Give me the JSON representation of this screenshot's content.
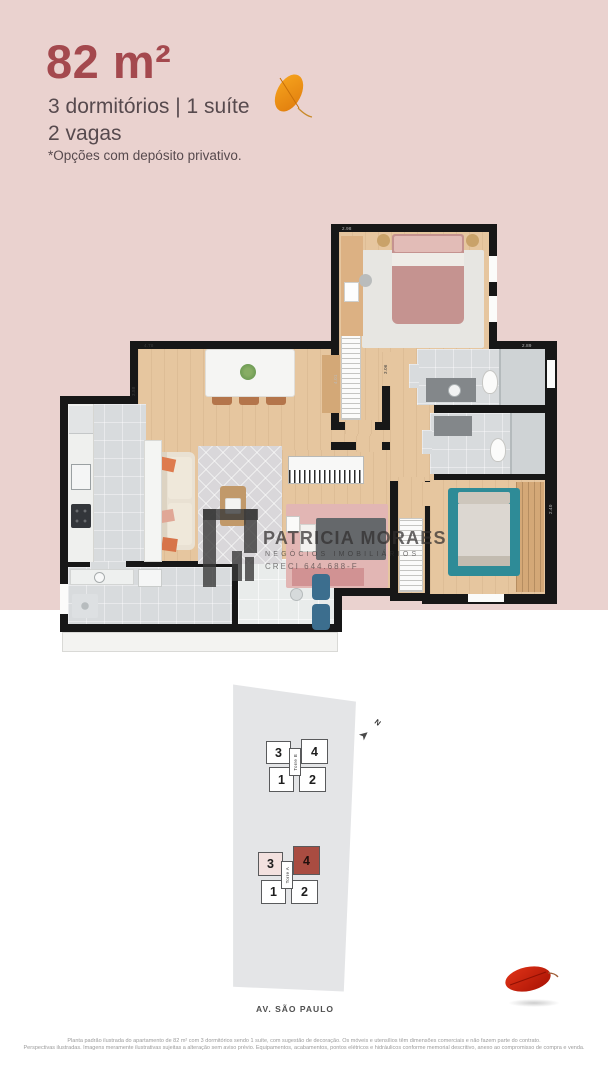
{
  "header": {
    "area": "82 m²",
    "features_line1": "3 dormitórios | 1 suíte",
    "features_line2": "2 vagas",
    "note": "*Opções com depósito privativo.",
    "accent_color": "#a4494e",
    "background_color": "#ead2cf"
  },
  "watermark": {
    "name": "PATRICIA MORAES",
    "subtitle": "NEGÓCIOS IMOBILIÁRIOS",
    "creci": "CRECI 644.688-F"
  },
  "floor_plan": {
    "dims": [
      "4.78",
      "3.58",
      "2.98",
      "2.89",
      "3.06",
      "2.40",
      "4.01"
    ]
  },
  "site_plan": {
    "north_label": "N",
    "towers": [
      {
        "name": "Torre B",
        "units": [
          "3",
          "4",
          "1",
          "2"
        ],
        "highlighted_unit": ""
      },
      {
        "name": "Torre A",
        "units": [
          "3",
          "4",
          "1",
          "2"
        ],
        "highlighted_unit": "4"
      }
    ],
    "street": "AV. SÃO PAULO",
    "highlight_color": "#a94c41"
  },
  "disclaimer": {
    "line1": "Planta padrão ilustrada do apartamento de 82 m² com 3 dormitórios sendo 1 suíte, com sugestão de decoração. Os móveis e utensílios têm dimensões comerciais e não fazem parte do contrato.",
    "line2": "Perspectivas ilustradas. Imagens meramente ilustrativas sujeitas a alteração sem aviso prévio. Equipamentos, acabamentos, pontos elétricos e hidráulicos conforme memorial descritivo, anexo ao compromisso de compra e venda."
  }
}
